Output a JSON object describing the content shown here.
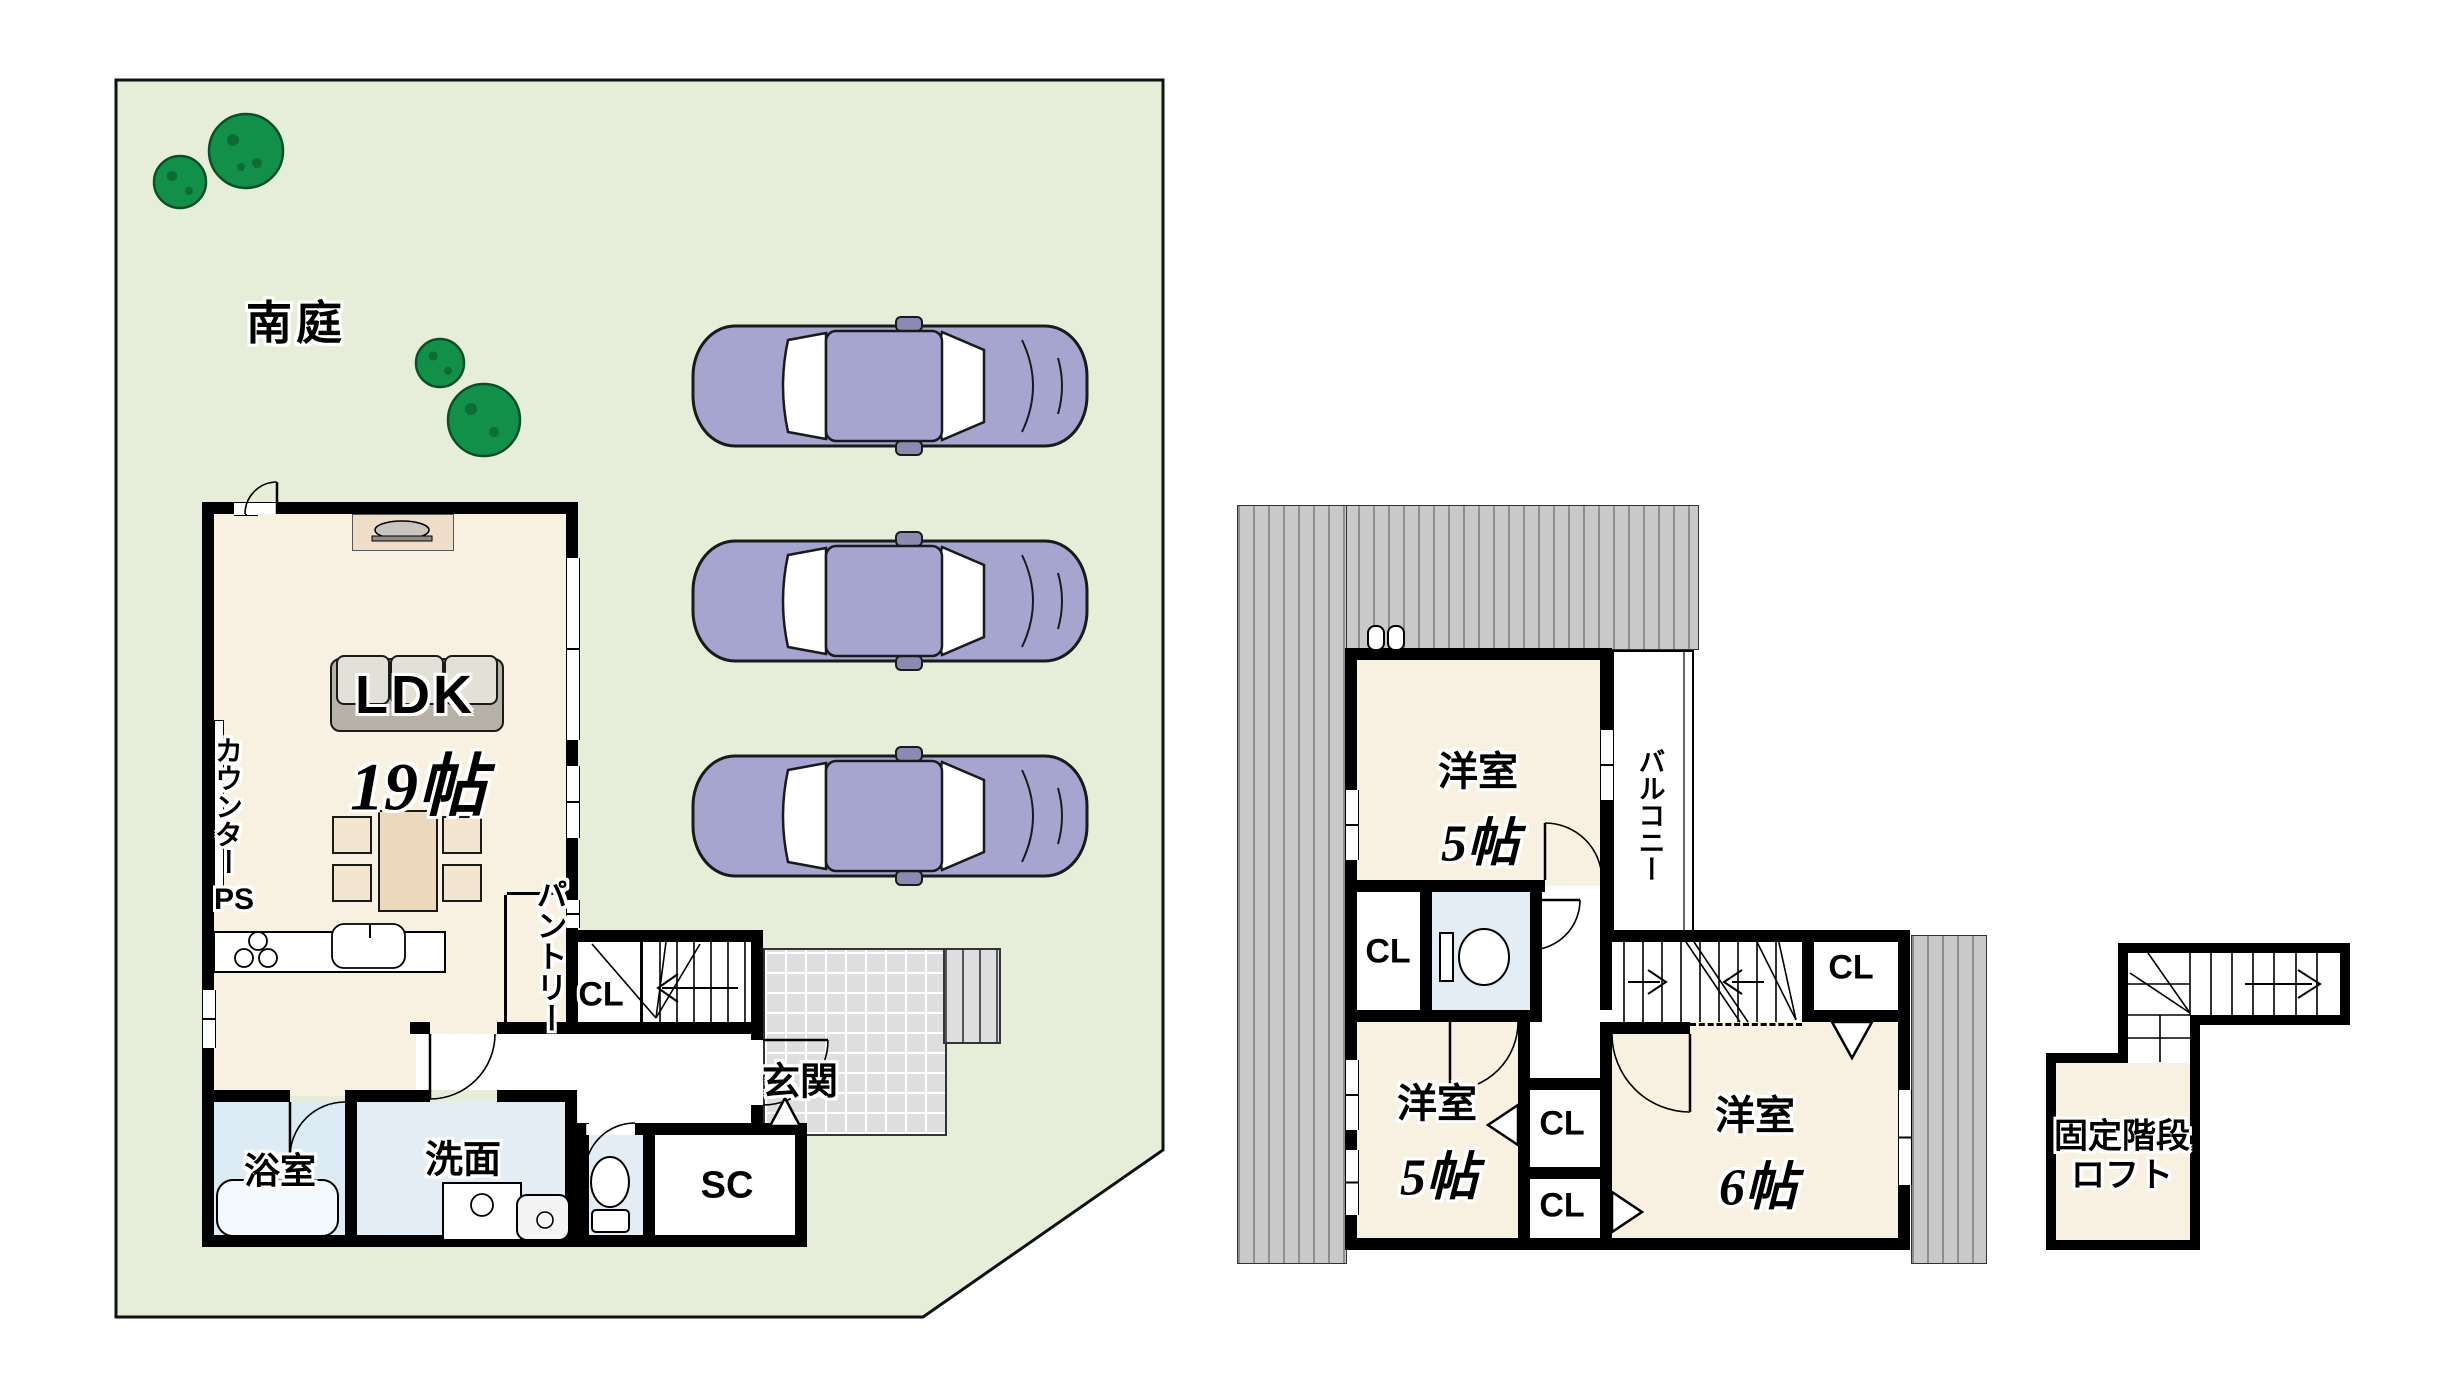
{
  "floor1": {
    "garden_label": "南庭",
    "ldk_name": "LDK",
    "ldk_size": "19帖",
    "counter_label": "カウンター",
    "ps_label": "PS",
    "pantry_label": "パントリー",
    "closet_label": "CL",
    "entrance_label": "玄関",
    "shoe_closet_label": "SC",
    "bath_label": "浴室",
    "washroom_label": "洗面"
  },
  "floor2": {
    "balcony_label": "バルコニー",
    "room_top_name": "洋室",
    "room_top_size": "5帖",
    "room_left_name": "洋室",
    "room_left_size": "5帖",
    "room_right_name": "洋室",
    "room_right_size": "6帖",
    "closet_top_label": "CL",
    "closet_stairs_label": "CL",
    "closet_mid_label": "CL",
    "closet_low_label": "CL"
  },
  "loft": {
    "label_line1": "固定階段",
    "label_line2": "ロフト"
  },
  "colors": {
    "garden_green": "#e6eed9",
    "room_cream": "#f8f1e1",
    "wet_blue": "#e2edf6",
    "bath_blue": "#dcebf4",
    "tile_grey": "#dedede",
    "roof_grey": "#c9c9c9",
    "car_purple": "#a6a5cf",
    "tree_green": "#12904a",
    "wood_tan": "#ecd9bd",
    "wall_black": "#000000"
  }
}
